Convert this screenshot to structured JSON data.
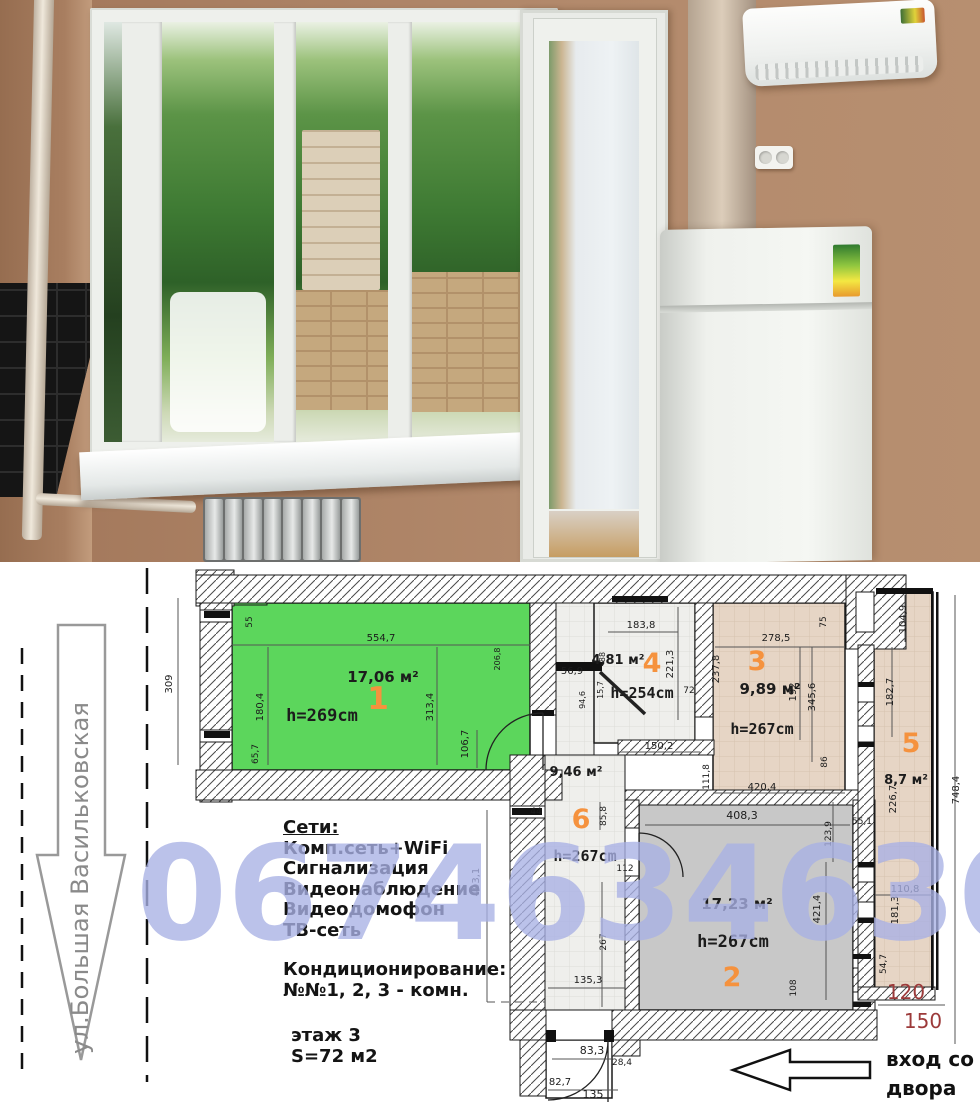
{
  "photo": {
    "palette": {
      "wall": "#b38a6c",
      "window_frame": "#eef0ec",
      "foliage": "#3e7a33",
      "tiles": "#151515",
      "fridge": "#f5f7f3",
      "sill": "#ffffff",
      "radiator": "#c9cccb",
      "duct": "#dccdba"
    }
  },
  "plan": {
    "street_label": "ул.Большая Васильковская",
    "entrance_label": "вход со двора",
    "watermark": "0674634636",
    "accent_orange": "#f5923e",
    "dim_red": "#9c3a3a",
    "info": {
      "networks_title": "Сети:",
      "networks": [
        "Комп.сеть+WiFi",
        "Сигнализация",
        "Видеонаблюдение",
        "Видеодомофон",
        "ТВ-сеть"
      ],
      "ac_title": "Кондиционирование:",
      "ac_note": "№№1, 2, 3  - комн.",
      "floor": "этаж 3",
      "total_area": "S=72 м2"
    },
    "rooms": {
      "r1": {
        "num": "1",
        "area": "17,06 м²",
        "h": "h=269cm"
      },
      "r2": {
        "num": "2",
        "area": "17,23 м²",
        "h": "h=267cm"
      },
      "r3": {
        "num": "3",
        "area": "9,89 м²",
        "h": "h=267cm"
      },
      "r4": {
        "num": "4",
        "area": "4,81 м²",
        "h": "h=254cm"
      },
      "r5": {
        "num": "5",
        "area": "8,7 м²"
      },
      "r6": {
        "num": "6",
        "area": "9,46 м²",
        "h": "h=267cm"
      }
    },
    "dims": {
      "d309": "309",
      "d55": "55",
      "d554_7": "554,7",
      "d180_4": "180,4",
      "d65_7": "65,7",
      "d313_4": "313,4",
      "d206_8": "206,8",
      "d106_7": "106,7",
      "d56_9": "56,9",
      "d94_6": "94,6",
      "d15_7": "15,7",
      "d88": "88",
      "d183_8": "183,8",
      "d221_3": "221,3",
      "d150_2": "150,2",
      "d72": "72",
      "d278_5": "278,5",
      "d237_8": "237,8",
      "d75": "75",
      "d192": "192",
      "d345_6": "345,6",
      "d86": "86",
      "d420_4": "420,4",
      "d111_8": "111,8",
      "d104_9": "104,9",
      "d182_7": "182,7",
      "d226_7": "226,7",
      "d55_1": "55,1",
      "d110_8": "110,8",
      "d181_3": "181,3",
      "d54_7": "54,7",
      "d748_4": "748,4",
      "d408_3": "408,3",
      "d123_9": "123,9",
      "d421_4": "421,4",
      "d108": "108",
      "d85_8": "85,8",
      "d44": "44",
      "d112": "112",
      "d267": "267",
      "d135_3": "135,3",
      "d493_1": "493,1",
      "d83_3": "83,3",
      "d28_4": "28,4",
      "d82_7": "82,7",
      "d135": "135",
      "d120": "120",
      "d150": "150"
    }
  }
}
